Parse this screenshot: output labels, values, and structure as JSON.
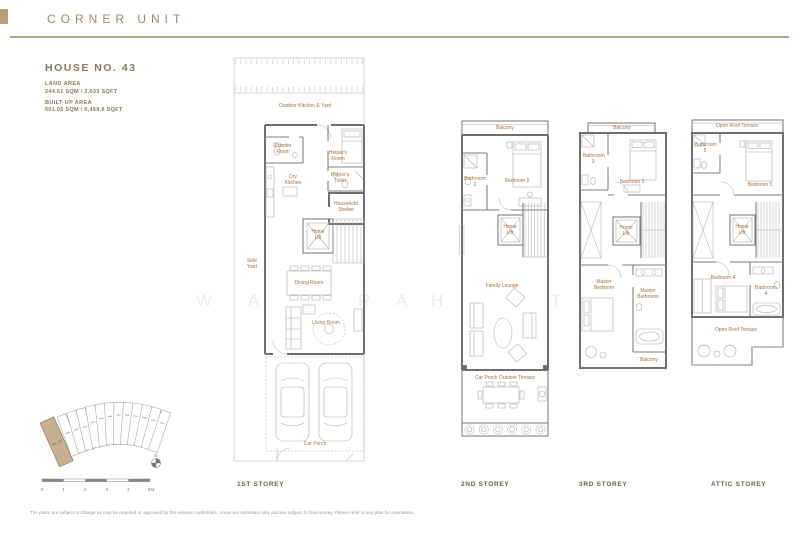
{
  "header": {
    "title": "CORNER UNIT"
  },
  "house": {
    "number": "HOUSE NO. 43",
    "land_area_label": "LAND AREA",
    "land_area_value": "244.61 SQM / 2,633 SQFT",
    "built_up_label": "BUILT-UP AREA",
    "built_up_value": "601.05 SQM / 6,469.6 SQFT"
  },
  "watermark": {
    "letters": [
      "W",
      "A",
      "R",
      "A",
      "H",
      "T"
    ]
  },
  "plans": [
    {
      "caption": "1ST STOREY",
      "rooms": {
        "outdoor_kitchen_yard": "Outdoor Kitchen & Yard",
        "powder_room": "Powder Room",
        "helpers_room": "Helper's Room",
        "helpers_toilet": "Helper's Toilet",
        "dry_kitchen": "Dry Kitchen",
        "household_shelter": "Household Shelter",
        "home_lift": "Home Lift",
        "side_yard": "Side Yard",
        "dining_room": "Dining Room",
        "living_room": "Living Room",
        "car_porch": "Car Porch"
      }
    },
    {
      "caption": "2ND STOREY",
      "rooms": {
        "balcony": "Balcony",
        "bathroom_2": "Bathroom 2",
        "bedroom_2": "Bedroom 2",
        "home_lift": "Home Lift",
        "family_lounge": "Family Lounge",
        "car_porch_outdoor_terrace": "Car Porch Outdoor Terrace"
      }
    },
    {
      "caption": "3RD STOREY",
      "rooms": {
        "balcony": "Balcony",
        "bathroom_3": "Bathroom 3",
        "bedroom_3": "Bedroom 3",
        "home_lift": "Home Lift",
        "master_bedroom": "Master Bedroom",
        "master_bathroom": "Master Bathroom",
        "balcony_rear": "Balcony"
      }
    },
    {
      "caption": "ATTIC STOREY",
      "rooms": {
        "open_roof_terrace": "Open Roof Terrace",
        "bathroom_5": "Bathroom 5",
        "bedroom_5": "Bedroom 5",
        "home_lift": "Home Lift",
        "bedroom_4": "Bedroom 4",
        "bathroom_4": "Bathroom 4",
        "open_roof_terrace_rear": "Open Roof Terrace"
      }
    }
  ],
  "keyplan": {
    "unit_label": "No. 43",
    "north_label": "N",
    "scale_labels": [
      "0",
      "1",
      "2",
      "3",
      "4",
      "5M"
    ]
  },
  "colors": {
    "accent_tan": "#b7a079",
    "room_label": "#a9713a",
    "highlight_lot": "#c7b091"
  },
  "disclaimer": "The plans are subject to change as may be required or approved by the relevant Authorities. Areas are estimates only and are subject to final survey. Please refer to key plan for orientation."
}
